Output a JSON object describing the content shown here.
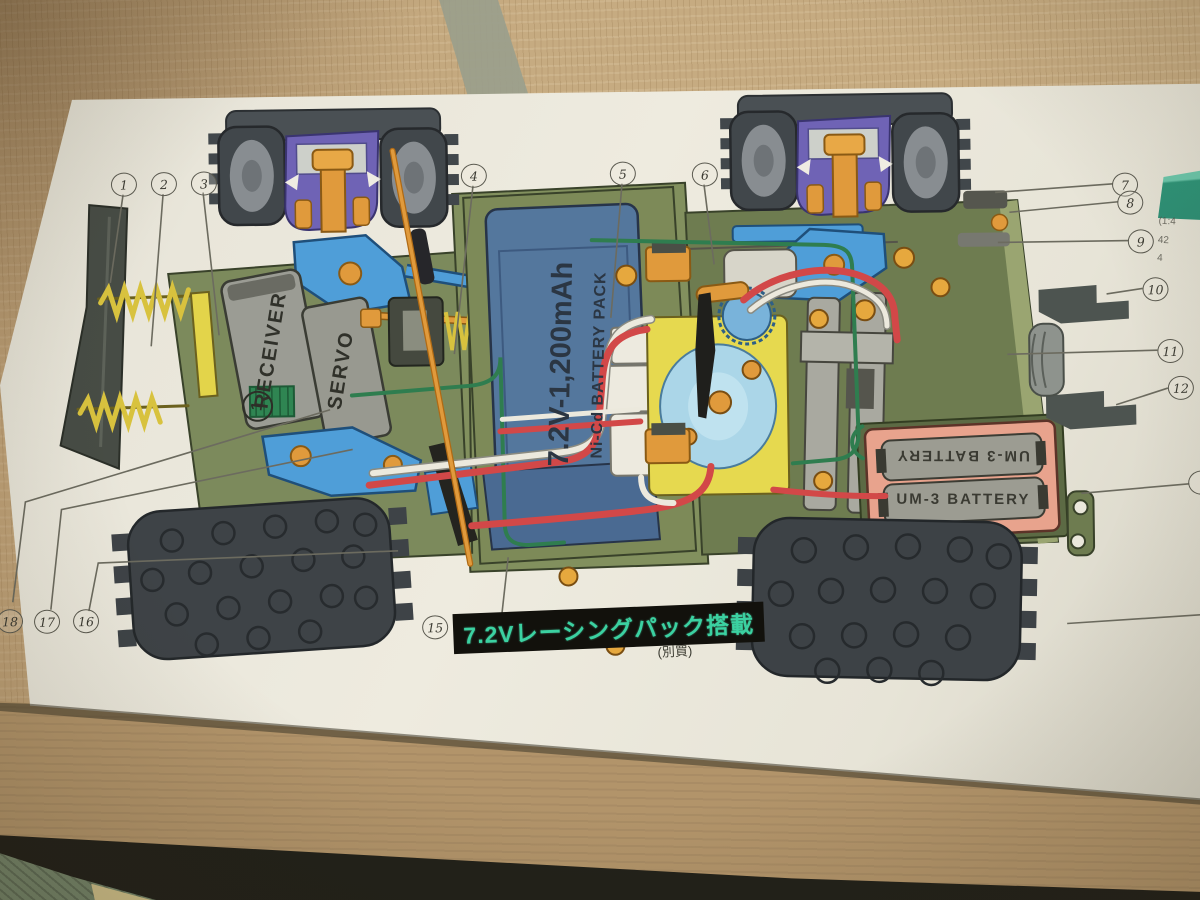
{
  "diagram": {
    "receiver_label": "RECEIVER",
    "receiver_channel": "1",
    "servo_label": "SERVO",
    "battery_capacity": "7.2V-1,200mAh",
    "battery_type": "Ni-Cd BATTERY PACK",
    "um3_top": "UM-3 BATTERY",
    "um3_bottom": "UM-3 BATTERY",
    "racing_pack_badge": "7.2Vレーシングパック搭載",
    "sold_separately": "(別買)",
    "callouts": [
      "1",
      "2",
      "3",
      "4",
      "5",
      "6",
      "7",
      "8",
      "9",
      "10",
      "11",
      "12",
      "15",
      "16",
      "17",
      "18"
    ],
    "edge_text": {
      "line1": "(1:4",
      "line2": "42",
      "line3": "4"
    }
  },
  "colors": {
    "box_cream": "#eae7db",
    "tatami_tan": "#c6ab81",
    "cardboard": "#b2946a",
    "chassis_green": "#7c8a5c",
    "battery_blue": "#54779d",
    "tire_gray": "#3e4347",
    "suspension_purple": "#6f63b5",
    "arm_blue": "#4f9ed8",
    "metal_orange": "#e09a3c",
    "wire_red": "#d24848",
    "wire_green": "#2f7d4f",
    "spring_yellow": "#d8c23e",
    "holder_pink": "#e8a38d",
    "badge_teal": "#3bd1a1",
    "strip_teal": "#2f9478"
  }
}
